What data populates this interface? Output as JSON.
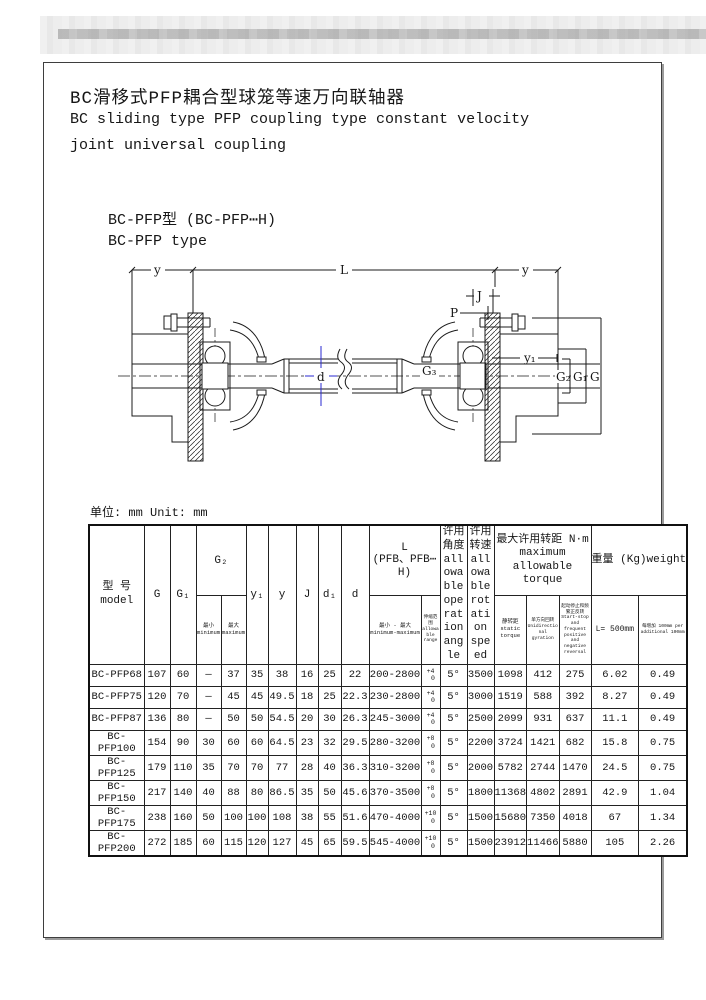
{
  "page": {
    "title_cn": "BC滑移式PFP耦合型球笼等速万向联轴器",
    "title_en_line1": "BC sliding type PFP coupling type constant velocity",
    "title_en_line2": "joint universal coupling",
    "subtitle_cn": "BC-PFP型  (BC-PFP⋯H)",
    "subtitle_en": "BC-PFP type",
    "unit_note": "单位: mm Unit: mm"
  },
  "drawing": {
    "d_dim_color": "#2a2ad0",
    "labels": {
      "y_left": "y",
      "L": "L",
      "y_right": "y",
      "J": "J",
      "P": "P",
      "y1": "y₁",
      "G3": "G₃",
      "d": "d",
      "G2": "G₂",
      "G1": "G₁",
      "G": "G"
    }
  },
  "table": {
    "headers": {
      "model_cn": "型 号",
      "model_en": "model",
      "g": "G",
      "g1": "G₁",
      "g2": "G₂",
      "g2_min": "最小 minimum",
      "g2_max": "最大 maximum",
      "y1": "y₁",
      "y": "y",
      "j": "J",
      "d1": "d₁",
      "d": "d",
      "L_line1": "L",
      "L_line2": "(PFB、PFB⋯H)",
      "L_minmax": "最小 - 最大 minimum-maximum",
      "L_range": "伸缩范围 allowable range",
      "angle": "许用角度 allowable operation angle",
      "speed": "许用转速 allowable rotation speed",
      "torque_group": "最大许用转距  N·m maximum allowable torque",
      "torque_static": "静转距 static torque",
      "torque_unidir": "单方向回转 Unidirectional gyration",
      "torque_startstop": "起动停止和频繁正反转 Start-stop and frequent positive and negative reversal",
      "weight_group": "重量 (Kg)weight",
      "weight_500": "L= 500mm",
      "weight_per": "每增加 100mm per additional 100mm"
    },
    "rows": [
      {
        "model": "BC-PFP68",
        "cells": [
          "107",
          "60",
          "—",
          "37",
          "35",
          "38",
          "16",
          "25",
          "22",
          "200-2800",
          "+4/0",
          "5°",
          "3500",
          "1098",
          "412",
          "275",
          "6.02",
          "0.49"
        ]
      },
      {
        "model": "BC-PFP75",
        "cells": [
          "120",
          "70",
          "—",
          "45",
          "45",
          "49.5",
          "18",
          "25",
          "22.3",
          "230-2800",
          "+4/0",
          "5°",
          "3000",
          "1519",
          "588",
          "392",
          "8.27",
          "0.49"
        ]
      },
      {
        "model": "BC-PFP87",
        "cells": [
          "136",
          "80",
          "—",
          "50",
          "50",
          "54.5",
          "20",
          "30",
          "26.3",
          "245-3000",
          "+4/0",
          "5°",
          "2500",
          "2099",
          "931",
          "637",
          "11.1",
          "0.49"
        ]
      },
      {
        "model": "BC-PFP100",
        "cells": [
          "154",
          "90",
          "30",
          "60",
          "60",
          "64.5",
          "23",
          "32",
          "29.5",
          "280-3200",
          "+8/0",
          "5°",
          "2200",
          "3724",
          "1421",
          "682",
          "15.8",
          "0.75"
        ]
      },
      {
        "model": "BC-PFP125",
        "cells": [
          "179",
          "110",
          "35",
          "70",
          "70",
          "77",
          "28",
          "40",
          "36.3",
          "310-3200",
          "+8/0",
          "5°",
          "2000",
          "5782",
          "2744",
          "1470",
          "24.5",
          "0.75"
        ]
      },
      {
        "model": "BC-PFP150",
        "cells": [
          "217",
          "140",
          "40",
          "88",
          "80",
          "86.5",
          "35",
          "50",
          "45.6",
          "370-3500",
          "+8/0",
          "5°",
          "1800",
          "11368",
          "4802",
          "2891",
          "42.9",
          "1.04"
        ]
      },
      {
        "model": "BC-PFP175",
        "cells": [
          "238",
          "160",
          "50",
          "100",
          "100",
          "108",
          "38",
          "55",
          "51.6",
          "470-4000",
          "+10/0",
          "5°",
          "1500",
          "15680",
          "7350",
          "4018",
          "67",
          "1.34"
        ]
      },
      {
        "model": "BC-PFP200",
        "cells": [
          "272",
          "185",
          "60",
          "115",
          "120",
          "127",
          "45",
          "65",
          "59.5",
          "545-4000",
          "+10/0",
          "5°",
          "1500",
          "23912",
          "11466",
          "5880",
          "105",
          "2.26"
        ]
      }
    ]
  }
}
